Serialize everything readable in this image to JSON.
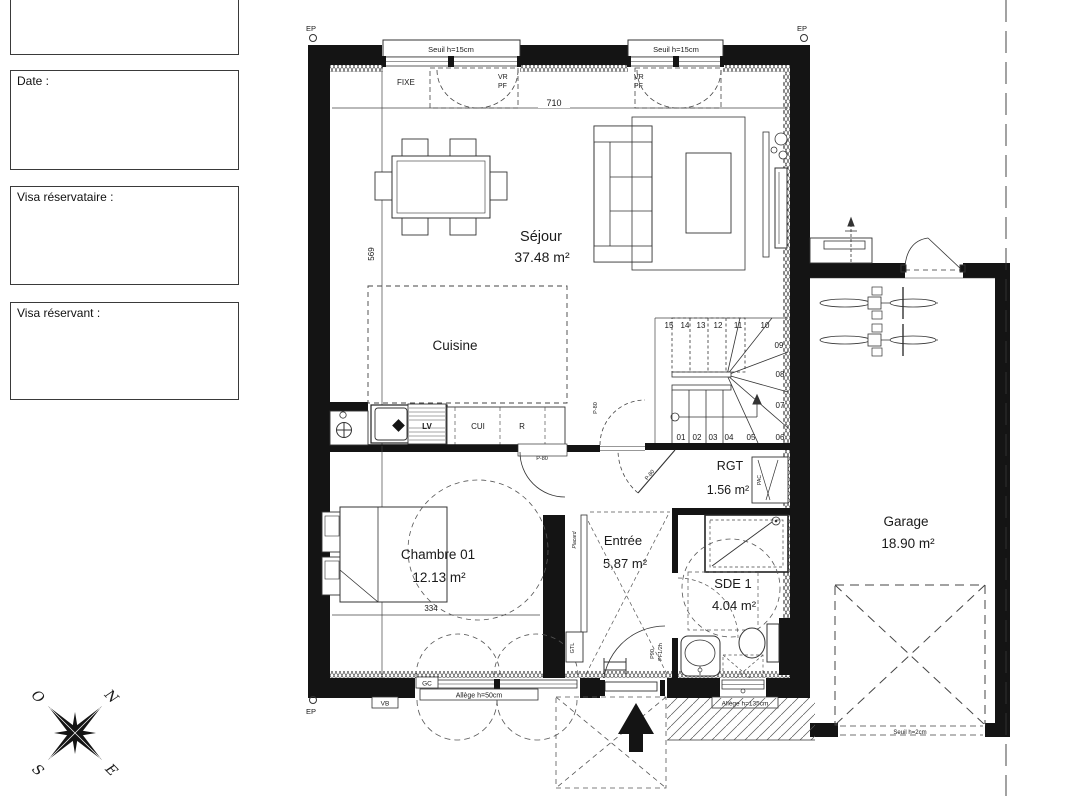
{
  "form": {
    "boxes": [
      {
        "label": ""
      },
      {
        "label": "Date :"
      },
      {
        "label": "Visa réservataire :"
      },
      {
        "label": "Visa réservant :"
      }
    ]
  },
  "compass": {
    "n": "N",
    "e": "E",
    "s": "S",
    "o": "O"
  },
  "rooms": {
    "sejour": {
      "name": "Séjour",
      "area": "37.48 m²"
    },
    "cuisine": {
      "name": "Cuisine"
    },
    "chambre": {
      "name": "Chambre 01",
      "area": "12.13 m²"
    },
    "entree": {
      "name": "Entrée",
      "area": "5,87 m²"
    },
    "rgt": {
      "name": "RGT",
      "area": "1.56 m²"
    },
    "sde": {
      "name": "SDE 1",
      "area": "4.04 m²"
    },
    "garage": {
      "name": "Garage",
      "area": "18.90 m²"
    }
  },
  "labels": {
    "ep": "EP",
    "seuil15": "Seuil h=15cm",
    "seuil2": "Seuil h=2cm",
    "fixe": "FIXE",
    "vr": "VR",
    "pf": "PF",
    "gc": "GC",
    "vb": "VB",
    "allege50": "Allège h=50cm",
    "allege135": "Allège h=135cm",
    "gtl": "GTL",
    "pac": "PAC",
    "placard": "Placard",
    "lv": "LV",
    "cui": "CUI",
    "r": "R",
    "p80": "P-80",
    "p90": "P90",
    "pf12h": "PF1/2h"
  },
  "dimensions": {
    "sejour_width": "710",
    "sejour_height": "569",
    "chambre_height": "343",
    "chambre_width": "334"
  },
  "stairs": {
    "numbers": [
      "01",
      "02",
      "03",
      "04",
      "05",
      "06",
      "07",
      "08",
      "09",
      "10",
      "11",
      "12",
      "13",
      "14",
      "15"
    ]
  }
}
